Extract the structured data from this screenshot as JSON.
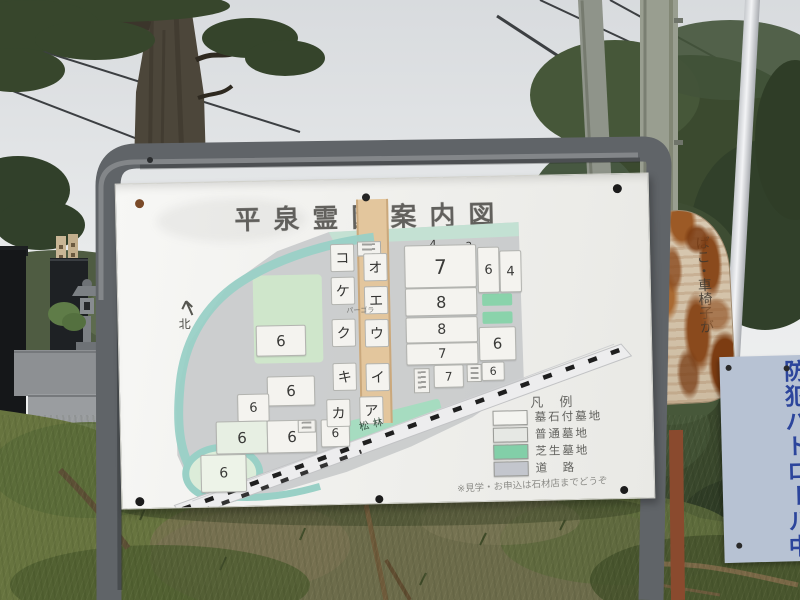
{
  "photo": {
    "board": {
      "title": "平泉霊園案内図",
      "map": {
        "north": "北",
        "pergola": "パーゴラ",
        "pine_grove": "松林",
        "katakana_left": [
          "コ",
          "ケ",
          "ク",
          "キ",
          "カ"
        ],
        "katakana_right": [
          "オ",
          "エ",
          "ウ",
          "イ",
          "ア"
        ],
        "blocks": [
          "4",
          "2",
          "7",
          "8",
          "8",
          "7",
          "7",
          "6",
          "6",
          "4",
          "6",
          "6",
          "6",
          "6",
          "6",
          "6",
          "6",
          "6"
        ],
        "legend": {
          "title": "凡 例",
          "items": [
            {
              "label": "墓石付墓地",
              "swatch": "#f4f4f0"
            },
            {
              "label": "普通墓地",
              "swatch": "#e6e8e4"
            },
            {
              "label": "芝生墓地",
              "swatch": "#82cfa8"
            },
            {
              "label": "道　路",
              "swatch": "#c3c6cd"
            }
          ],
          "note": "※見学・お申込は石材店までどうぞ"
        }
      }
    },
    "rusty_sign": {
      "column1": "ばこ・車椅子が",
      "column2": "里中案内所"
    },
    "patrol_sign": {
      "text": "防犯パトロール中"
    },
    "colors": {
      "river_teal": "#99d0c6",
      "lawn_green": "#82cfa8",
      "path_orange": "#e3c69d",
      "patrol_blue": "#2c459c"
    }
  }
}
